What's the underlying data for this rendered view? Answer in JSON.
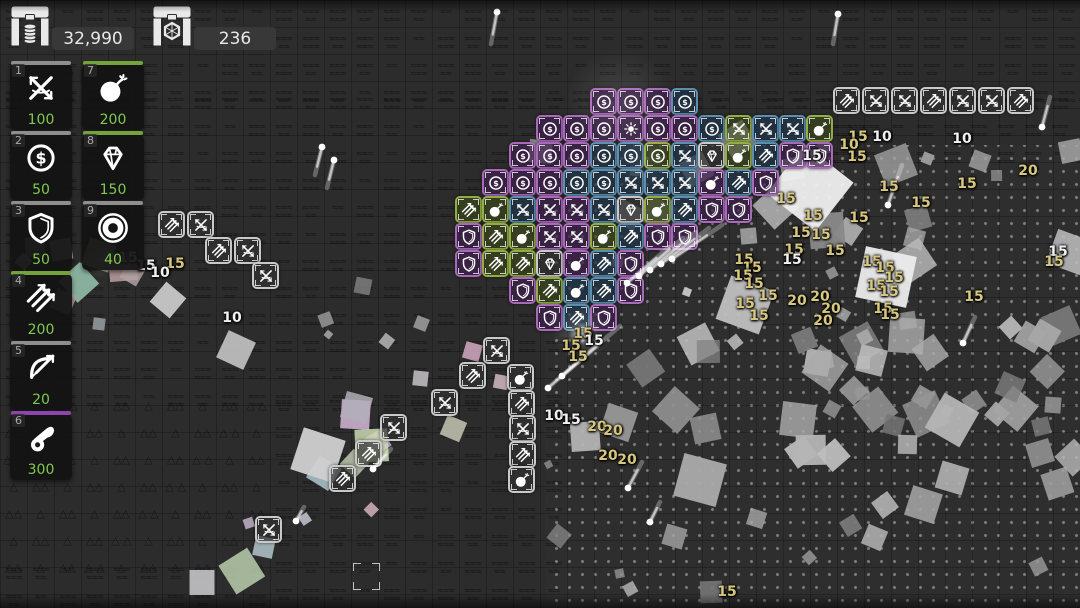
{
  "hud": {
    "gold": {
      "icon": "gold-chest",
      "value": "32,990"
    },
    "gems": {
      "icon": "gem-chest",
      "value": "236"
    }
  },
  "shop": {
    "slots": [
      {
        "key": "1",
        "icon": "crossbow",
        "price": "100",
        "bar": "#8e8e8e",
        "x": 10,
        "y": 64
      },
      {
        "key": "7",
        "icon": "bomb",
        "price": "200",
        "bar": "#74a33c",
        "x": 82,
        "y": 64
      },
      {
        "key": "2",
        "icon": "coin",
        "price": "50",
        "bar": "#8e8e8e",
        "x": 10,
        "y": 134
      },
      {
        "key": "8",
        "icon": "diamond",
        "price": "150",
        "bar": "#74a33c",
        "x": 82,
        "y": 134
      },
      {
        "key": "3",
        "icon": "shield",
        "price": "50",
        "bar": "#8e8e8e",
        "x": 10,
        "y": 204
      },
      {
        "key": "9",
        "icon": "ring",
        "price": "40",
        "bar": "#8e8e8e",
        "x": 82,
        "y": 204
      },
      {
        "key": "4",
        "icon": "arrows",
        "price": "200",
        "bar": "#74a33c",
        "x": 10,
        "y": 274
      },
      {
        "key": "5",
        "icon": "bow",
        "price": "20",
        "bar": "#8e8e8e",
        "x": 10,
        "y": 344
      },
      {
        "key": "6",
        "icon": "cannon",
        "price": "300",
        "bar": "#8e44ad",
        "x": 10,
        "y": 414
      }
    ]
  },
  "palette": {
    "P": {
      "border": "#a86ab8",
      "bg": "rgba(62,30,78,0.72)"
    },
    "B": {
      "border": "#5b8fb0",
      "bg": "rgba(30,52,74,0.72)"
    },
    "G": {
      "border": "#93ad45",
      "bg": "rgba(58,72,24,0.65)"
    },
    "W": {
      "border": "#c9c9c9",
      "bg": "rgba(48,48,48,0.70)"
    },
    "price": "#7ecb4f",
    "tan": "#d8c87f",
    "white": "#f1f1f1"
  },
  "board": {
    "grid": {
      "origin_x": 455,
      "origin_y": 88,
      "pitch": 27
    },
    "pyramid_rows": [
      {
        "y": 88,
        "col": 5,
        "tiles": [
          "coin:P",
          "coin:P",
          "coin:P",
          "coin:B"
        ]
      },
      {
        "y": 115,
        "col": 3,
        "tiles": [
          "coin:P",
          "coin:P",
          "coin:P",
          "sun:P",
          "coin:P",
          "coin:P",
          "coin:B",
          "xbow:G",
          "xbow:B",
          "xbow:B",
          "bomb:G"
        ]
      },
      {
        "y": 142,
        "col": 2,
        "tiles": [
          "coin:P",
          "coin:P",
          "coin:P",
          "coin:B",
          "coin:B",
          "coin:G",
          "xbow:B",
          "diamond:W",
          "bomb:G",
          "arrows:B",
          "shield:P",
          "shield:P"
        ]
      },
      {
        "y": 169,
        "col": 1,
        "tiles": [
          "coin:P",
          "coin:P",
          "coin:P",
          "coin:B",
          "coin:B",
          "xbow:B",
          "xbow:B",
          "xbow:B",
          "bomb:P",
          "arrows:B",
          "shield:P"
        ]
      },
      {
        "y": 196,
        "col": 0,
        "tiles": [
          "arrows:G",
          "bomb:G",
          "xbow:B",
          "xbow:P",
          "xbow:P",
          "xbow:B",
          "diamond:W",
          "bomb:G",
          "arrows:B",
          "shield:P",
          "shield:P"
        ]
      },
      {
        "y": 223,
        "col": 0,
        "tiles": [
          "shield:P",
          "arrows:G",
          "bomb:G",
          "xbow:P",
          "xbow:P",
          "bomb:G",
          "arrows:B",
          "shield:P",
          "shield:P"
        ]
      },
      {
        "y": 250,
        "col": 0,
        "tiles": [
          "shield:P",
          "arrows:G",
          "arrows:G",
          "diamond:W",
          "bomb:P",
          "arrows:B",
          "shield:P"
        ]
      },
      {
        "y": 277,
        "col": 2,
        "tiles": [
          "shield:P",
          "arrows:G",
          "bomb:B",
          "arrows:B",
          "shield:P"
        ]
      },
      {
        "y": 304,
        "col": 3,
        "tiles": [
          "shield:P",
          "arrows:B",
          "shield:P"
        ]
      }
    ],
    "white_row": {
      "x": 833,
      "y": 87,
      "pitch": 29,
      "tiles": [
        "arrows",
        "xbow",
        "xbow",
        "arrows",
        "xbow",
        "xbow",
        "arrows"
      ]
    },
    "scattered_tiles": [
      {
        "x": 158,
        "y": 211,
        "icon": "arrows"
      },
      {
        "x": 187,
        "y": 211,
        "icon": "xbow"
      },
      {
        "x": 205,
        "y": 237,
        "icon": "arrows"
      },
      {
        "x": 234,
        "y": 237,
        "icon": "xbow"
      },
      {
        "x": 252,
        "y": 262,
        "icon": "xbow"
      },
      {
        "x": 483,
        "y": 337,
        "icon": "xbow"
      },
      {
        "x": 459,
        "y": 362,
        "icon": "arrows"
      },
      {
        "x": 507,
        "y": 364,
        "icon": "bomb"
      },
      {
        "x": 431,
        "y": 389,
        "icon": "xbow"
      },
      {
        "x": 508,
        "y": 390,
        "icon": "arrows"
      },
      {
        "x": 380,
        "y": 414,
        "icon": "xbow"
      },
      {
        "x": 509,
        "y": 415,
        "icon": "xbow"
      },
      {
        "x": 355,
        "y": 440,
        "icon": "arrows"
      },
      {
        "x": 509,
        "y": 441,
        "icon": "arrows"
      },
      {
        "x": 329,
        "y": 465,
        "icon": "arrows"
      },
      {
        "x": 508,
        "y": 466,
        "icon": "bomb"
      },
      {
        "x": 255,
        "y": 516,
        "icon": "xbow"
      }
    ],
    "damage_numbers": [
      {
        "x": 128,
        "y": 258,
        "v": "15",
        "c": "w"
      },
      {
        "x": 146,
        "y": 266,
        "v": "15",
        "c": "w"
      },
      {
        "x": 175,
        "y": 264,
        "v": "15",
        "c": "t"
      },
      {
        "x": 160,
        "y": 273,
        "v": "10",
        "c": "w"
      },
      {
        "x": 232,
        "y": 318,
        "v": "10",
        "c": "w"
      },
      {
        "x": 583,
        "y": 334,
        "v": "15",
        "c": "t"
      },
      {
        "x": 571,
        "y": 346,
        "v": "15",
        "c": "t"
      },
      {
        "x": 578,
        "y": 357,
        "v": "15",
        "c": "t"
      },
      {
        "x": 594,
        "y": 341,
        "v": "15",
        "c": "w"
      },
      {
        "x": 554,
        "y": 416,
        "v": "10",
        "c": "w"
      },
      {
        "x": 571,
        "y": 420,
        "v": "15",
        "c": "w"
      },
      {
        "x": 597,
        "y": 427,
        "v": "20",
        "c": "t"
      },
      {
        "x": 613,
        "y": 431,
        "v": "20",
        "c": "t"
      },
      {
        "x": 608,
        "y": 456,
        "v": "20",
        "c": "t"
      },
      {
        "x": 627,
        "y": 460,
        "v": "20",
        "c": "t"
      },
      {
        "x": 744,
        "y": 260,
        "v": "15",
        "c": "t"
      },
      {
        "x": 752,
        "y": 268,
        "v": "15",
        "c": "t"
      },
      {
        "x": 743,
        "y": 276,
        "v": "15",
        "c": "t"
      },
      {
        "x": 754,
        "y": 284,
        "v": "15",
        "c": "t"
      },
      {
        "x": 768,
        "y": 296,
        "v": "15",
        "c": "t"
      },
      {
        "x": 745,
        "y": 304,
        "v": "15",
        "c": "t"
      },
      {
        "x": 759,
        "y": 316,
        "v": "15",
        "c": "t"
      },
      {
        "x": 797,
        "y": 301,
        "v": "20",
        "c": "t"
      },
      {
        "x": 820,
        "y": 297,
        "v": "20",
        "c": "t"
      },
      {
        "x": 831,
        "y": 309,
        "v": "20",
        "c": "t"
      },
      {
        "x": 823,
        "y": 321,
        "v": "20",
        "c": "t"
      },
      {
        "x": 858,
        "y": 137,
        "v": "15",
        "c": "t"
      },
      {
        "x": 849,
        "y": 145,
        "v": "10",
        "c": "t"
      },
      {
        "x": 882,
        "y": 137,
        "v": "10",
        "c": "w"
      },
      {
        "x": 857,
        "y": 157,
        "v": "15",
        "c": "t"
      },
      {
        "x": 812,
        "y": 156,
        "v": "15",
        "c": "w"
      },
      {
        "x": 962,
        "y": 139,
        "v": "10",
        "c": "w"
      },
      {
        "x": 889,
        "y": 187,
        "v": "15",
        "c": "t"
      },
      {
        "x": 921,
        "y": 203,
        "v": "15",
        "c": "t"
      },
      {
        "x": 786,
        "y": 199,
        "v": "15",
        "c": "t"
      },
      {
        "x": 813,
        "y": 216,
        "v": "15",
        "c": "t"
      },
      {
        "x": 859,
        "y": 218,
        "v": "15",
        "c": "t"
      },
      {
        "x": 967,
        "y": 184,
        "v": "15",
        "c": "t"
      },
      {
        "x": 801,
        "y": 233,
        "v": "15",
        "c": "t"
      },
      {
        "x": 821,
        "y": 235,
        "v": "15",
        "c": "t"
      },
      {
        "x": 794,
        "y": 250,
        "v": "15",
        "c": "t"
      },
      {
        "x": 835,
        "y": 251,
        "v": "15",
        "c": "t"
      },
      {
        "x": 792,
        "y": 260,
        "v": "15",
        "c": "w"
      },
      {
        "x": 1028,
        "y": 171,
        "v": "20",
        "c": "t"
      },
      {
        "x": 872,
        "y": 262,
        "v": "15",
        "c": "t"
      },
      {
        "x": 885,
        "y": 268,
        "v": "15",
        "c": "t"
      },
      {
        "x": 894,
        "y": 278,
        "v": "15",
        "c": "t"
      },
      {
        "x": 876,
        "y": 286,
        "v": "15",
        "c": "t"
      },
      {
        "x": 889,
        "y": 292,
        "v": "15",
        "c": "t"
      },
      {
        "x": 974,
        "y": 297,
        "v": "15",
        "c": "t"
      },
      {
        "x": 883,
        "y": 309,
        "v": "15",
        "c": "t"
      },
      {
        "x": 890,
        "y": 315,
        "v": "15",
        "c": "t"
      },
      {
        "x": 727,
        "y": 592,
        "v": "15",
        "c": "t"
      },
      {
        "x": 1058,
        "y": 252,
        "v": "15",
        "c": "w"
      },
      {
        "x": 1054,
        "y": 262,
        "v": "15",
        "c": "t"
      }
    ],
    "projectiles": [
      {
        "x": 497,
        "y": 12,
        "tx": -6,
        "ty": 32
      },
      {
        "x": 322,
        "y": 147,
        "tx": -7,
        "ty": 28
      },
      {
        "x": 334,
        "y": 160,
        "tx": -7,
        "ty": 28
      },
      {
        "x": 838,
        "y": 14,
        "tx": -5,
        "ty": 30
      },
      {
        "x": 627,
        "y": 283,
        "tx": 42,
        "ty": -36
      },
      {
        "x": 639,
        "y": 276,
        "tx": 44,
        "ty": -38
      },
      {
        "x": 650,
        "y": 270,
        "tx": 46,
        "ty": -38
      },
      {
        "x": 661,
        "y": 264,
        "tx": 48,
        "ty": -36
      },
      {
        "x": 672,
        "y": 259,
        "tx": 50,
        "ty": -34
      },
      {
        "x": 548,
        "y": 388,
        "tx": 55,
        "ty": -48
      },
      {
        "x": 562,
        "y": 376,
        "tx": 58,
        "ty": -50
      },
      {
        "x": 373,
        "y": 469,
        "tx": 18,
        "ty": -20
      },
      {
        "x": 628,
        "y": 488,
        "tx": 14,
        "ty": -26
      },
      {
        "x": 650,
        "y": 522,
        "tx": 10,
        "ty": -20
      },
      {
        "x": 296,
        "y": 521,
        "tx": 8,
        "ty": -14
      },
      {
        "x": 888,
        "y": 205,
        "tx": 14,
        "ty": -40
      },
      {
        "x": 963,
        "y": 343,
        "tx": 12,
        "ty": -26
      },
      {
        "x": 1042,
        "y": 127,
        "tx": 8,
        "ty": -30
      }
    ],
    "glows": [
      {
        "x": 620,
        "y": 103,
        "r": 55,
        "o": 0.13
      },
      {
        "x": 643,
        "y": 158,
        "r": 30,
        "o": 0.08
      },
      {
        "x": 581,
        "y": 334,
        "r": 12,
        "o": 0.85
      },
      {
        "x": 581,
        "y": 334,
        "r": 28,
        "o": 0.22
      },
      {
        "x": 100,
        "y": 262,
        "r": 16,
        "o": 0.3
      }
    ],
    "big_debris": [
      {
        "x": 810,
        "y": 188,
        "s": 62,
        "rot": 38,
        "c": "#efefef",
        "shape": "sq"
      },
      {
        "x": 886,
        "y": 277,
        "s": 52,
        "rot": 12,
        "c": "#ececec",
        "shape": "sq"
      },
      {
        "x": 318,
        "y": 455,
        "s": 44,
        "rot": 18,
        "c": "#d0d0d0",
        "shape": "sq"
      },
      {
        "x": 395,
        "y": 308,
        "s": 52,
        "rot": 0,
        "c": "#d8d8d8",
        "shape": "tri"
      },
      {
        "x": 283,
        "y": 428,
        "s": 38,
        "rot": 10,
        "c": "#cfcfcf",
        "shape": "tri"
      },
      {
        "x": 236,
        "y": 350,
        "s": 30,
        "rot": 25,
        "c": "#bdbdbd",
        "shape": "sq"
      },
      {
        "x": 168,
        "y": 300,
        "s": 26,
        "rot": 40,
        "c": "#c8c8c8",
        "shape": "sq"
      },
      {
        "x": 745,
        "y": 305,
        "s": 46,
        "rot": 20,
        "c": "#c0c0c0",
        "shape": "sq"
      },
      {
        "x": 952,
        "y": 420,
        "s": 40,
        "rot": 30,
        "c": "#b5b5b5",
        "shape": "sq"
      },
      {
        "x": 700,
        "y": 480,
        "s": 44,
        "rot": 15,
        "c": "#ababab",
        "shape": "sq"
      }
    ],
    "cursor": {
      "x": 353,
      "y": 563,
      "size": 27
    },
    "terrain": {
      "water": [
        [
          0,
          0,
          1080,
          88
        ],
        [
          0,
          88,
          545,
          302
        ],
        [
          270,
          390,
          275,
          218
        ],
        [
          0,
          558,
          270,
          50
        ],
        [
          545,
          88,
          300,
          57
        ],
        [
          830,
          88,
          250,
          57
        ]
      ],
      "mountains": [
        [
          0,
          390,
          270,
          168
        ]
      ],
      "dots": [
        [
          545,
          145,
          535,
          463
        ]
      ]
    }
  }
}
